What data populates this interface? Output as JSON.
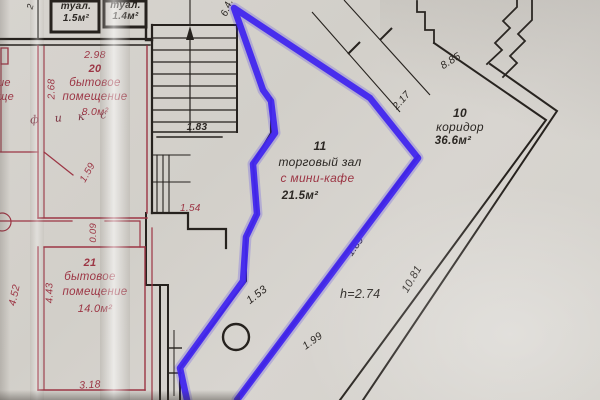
{
  "colors": {
    "paper": "#d5d2cc",
    "ink_black": "#26221e",
    "ink_red": "#9c3544",
    "highlight_blue": "#4227ee"
  },
  "rooms": {
    "wc_left": {
      "name": "туал.",
      "area": "1.5м²"
    },
    "wc_right": {
      "name": "туал.",
      "area": "1.4м²"
    },
    "room20": {
      "number": "20",
      "name_line1": "бытовое",
      "name_line2": "помещение",
      "area": "8.0м²"
    },
    "room21": {
      "number": "21",
      "name_line1": "бытовое",
      "name_line2": "помещение",
      "area": "14.0м²"
    },
    "room11": {
      "number": "11",
      "name": "торговый зал",
      "subtitle": "с мини-кафе",
      "area": "21.5м²"
    },
    "room10": {
      "number": "10",
      "name": "коридор",
      "area": "36.6м²"
    }
  },
  "dimensions": {
    "d298": "2.98",
    "d268": "2.68",
    "d183": "1.83",
    "d159": "1.59",
    "d154": "1.54",
    "d009": "0.09",
    "d452": "4.52",
    "d443": "4.43",
    "d318": "3.18",
    "d64": "6.4.",
    "d217": "2.17",
    "d885": "8.85",
    "d189": "1.89",
    "d1081": "10.81",
    "h274": "h=2.74",
    "d153": "1.53",
    "d199": "1.99",
    "d2cut": "2"
  },
  "annotations": {
    "handwritten": "фикс",
    "edge_fragment_1": "ие",
    "edge_fragment_2": "ще"
  }
}
